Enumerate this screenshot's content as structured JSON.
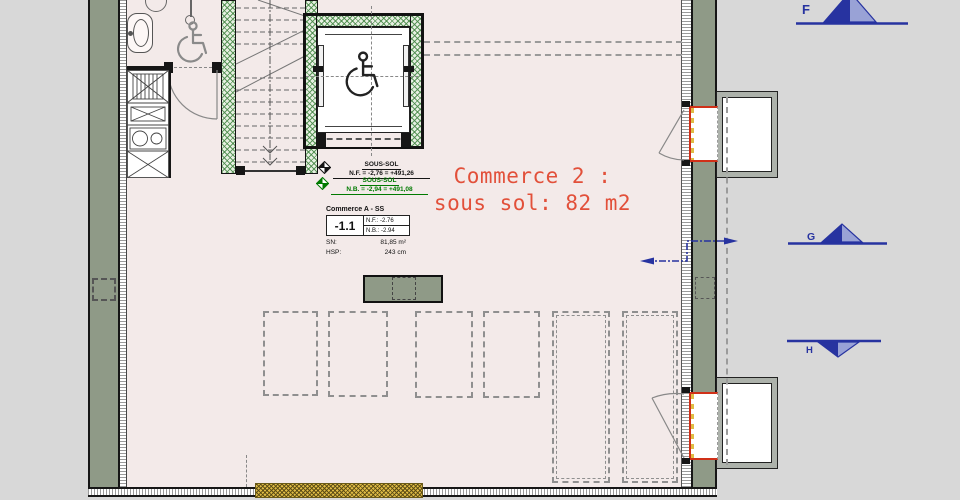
{
  "colors": {
    "canvas_bg": "#d8d8d8",
    "floor": "#f3eae9",
    "wall_green": "#8f9a87",
    "hatch_wall_bg": "#e7f0e2",
    "accent_red": "#e2503a",
    "opening_red": "#d03018",
    "marker_navy": "#2733a0",
    "level_green": "#007a00",
    "insulation_yellow": "#e0bc45"
  },
  "room_label": {
    "line1": "Commerce 2 :",
    "line2": "sous sol: 82 m2"
  },
  "levels": [
    {
      "name": "SOUS-SOL",
      "value": "N.F. = -2,76 = +491,26"
    },
    {
      "name": "SOUS-SOL",
      "value": "N.B. = -2,94 = +491,08"
    }
  ],
  "info_box": {
    "title": "Commerce A - SS",
    "unit_number": "-1.1",
    "nf": "N.F.: -2.76",
    "nb": "N.B.: -2.94",
    "sn_label": "SN:",
    "sn_value": "81,85 m²",
    "hsp_label": "HSP:",
    "hsp_value": "243 cm"
  },
  "section_markers": {
    "top": "F",
    "middle": "G",
    "bottom": "H"
  },
  "icons": {
    "wheelchair-icon": "♿",
    "level-benchmark-icon": "◇",
    "section-cut-icon": "◭",
    "door-swing-icon": "arc",
    "stairs-icon": "≡"
  }
}
